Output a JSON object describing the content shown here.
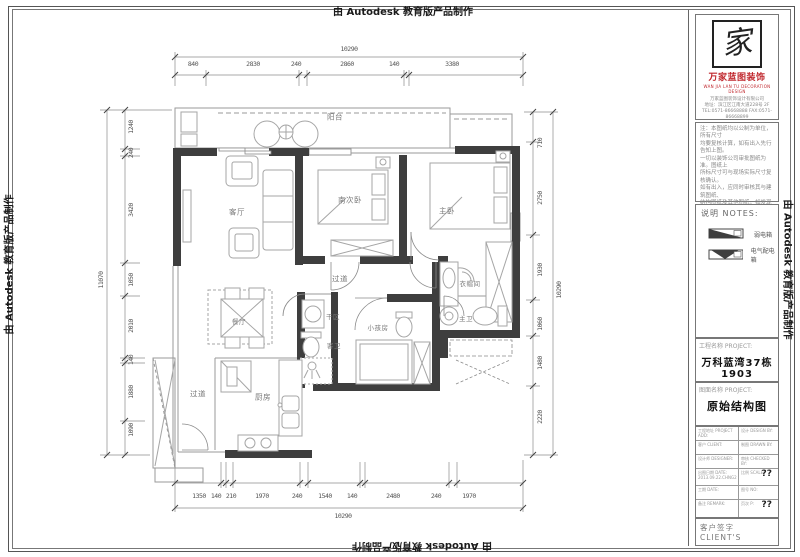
{
  "watermark": {
    "text": "由 Autodesk 教育版产品制作"
  },
  "plan": {
    "rooms": [
      {
        "id": "balcony",
        "label": "阳台"
      },
      {
        "id": "living",
        "label": "客厅"
      },
      {
        "id": "south-bedroom",
        "label": "南次卧"
      },
      {
        "id": "master-bedroom",
        "label": "主卧"
      },
      {
        "id": "corridor-upper",
        "label": "过道"
      },
      {
        "id": "dry-area",
        "label": "干区"
      },
      {
        "id": "guest-bath",
        "label": "客卫"
      },
      {
        "id": "kids-room",
        "label": "小孩房"
      },
      {
        "id": "cloakroom",
        "label": "衣帽间"
      },
      {
        "id": "master-bath",
        "label": "主卫"
      },
      {
        "id": "dining",
        "label": "餐厅"
      },
      {
        "id": "corridor-lower",
        "label": "过道"
      },
      {
        "id": "kitchen",
        "label": "厨房"
      }
    ],
    "dims": {
      "top": {
        "total": "10290",
        "segments": [
          "840",
          "2830",
          "240",
          "2860",
          "140",
          "3380"
        ]
      },
      "bottom": {
        "total": "10290",
        "segments": [
          "1350",
          "140",
          "210",
          "1970",
          "240",
          "1540",
          "140",
          "2480",
          "240",
          "1970"
        ]
      },
      "left": {
        "total": "11070",
        "segments": [
          "1240",
          "240",
          "3420",
          "1050",
          "2010",
          "140",
          "1880",
          "1090"
        ]
      },
      "right": {
        "total": "10290",
        "segments": [
          "710",
          "2750",
          "1930",
          "1060",
          "1480",
          "2220"
        ]
      }
    }
  },
  "panel": {
    "logo": {
      "char": "家",
      "name": "万家蓝图装饰",
      "sub": "WAN JIA LAN TU DECORATION DESIGN",
      "company": "万家蓝图装饰设计有限公司\n地址：滨江区江南大道228号 2F\nTEL:0571-86668888  FAX:0571-86668899"
    },
    "notes_text": "注：本图纸均以公制为单位，所有尺寸\n均要复核计算，如有出入先行告知上图。\n一切以装饰公司审批图纸为准。图纸上\n所标尺寸可与现场实际尺寸复核确认。\n如有出入，应同时审核其与建筑图纸、\n结构图纸及其他图纸，如发现有矛盾处\n请及时通知设计师予以更改确认无误。\n此图版权归设计单位所有。",
    "notes_header": "说明   NOTES:",
    "legend": [
      {
        "label": "弱电箱"
      },
      {
        "label": "电气配电箱"
      }
    ],
    "project": {
      "label": "工程名称 PROJECT:",
      "value": "万科蓝湾37栋1903"
    },
    "drawing": {
      "label": "图面名称 PROJECT:",
      "value": "原始结构图"
    },
    "info_table": {
      "rows": [
        {
          "l": "工程地址 PROJECT ADD:",
          "r": "设计 DESIGN BY:"
        },
        {
          "l": "客户 CLIENT:",
          "r": "制图 DRAWN BY:"
        },
        {
          "l": "设计师 DESIGNER:",
          "r": "审核 CHECKED BY:"
        },
        {
          "l": "出图日期 DATE:\n2013.09.22.CHNG2",
          "r": "比例 SCALE:",
          "rb": "??"
        },
        {
          "l": "工期 DATE:",
          "r": "图号 NO:"
        },
        {
          "l": "备注 REMARK:",
          "r": "页次 P:",
          "rb": "??"
        }
      ]
    },
    "client": {
      "label": "客户签字 CLIENT'S"
    }
  }
}
